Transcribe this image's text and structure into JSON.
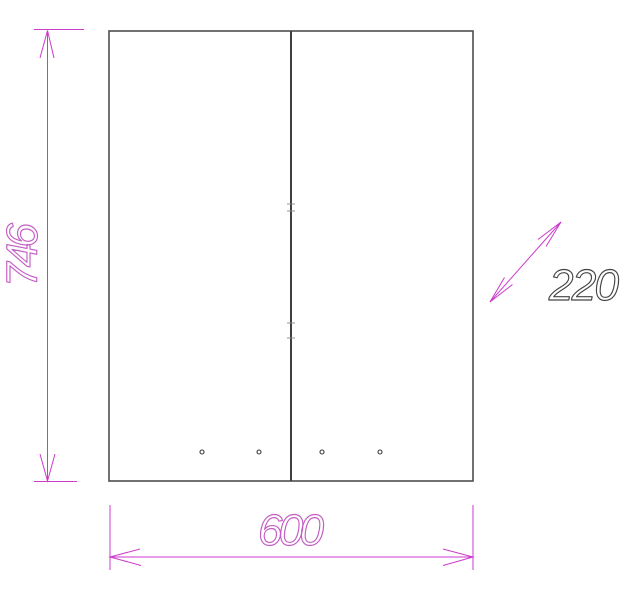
{
  "drawing": {
    "labels": {
      "height": "746",
      "width": "600",
      "depth": "220"
    },
    "colors": {
      "dimension": "#cc3acc",
      "dimension_text": "#c45ec4",
      "outline": "#4e4e4e",
      "divider": "#3f3f3f",
      "hinge_mark": "#8a8a8a",
      "hole": "#3a3a3a",
      "depth_text": "#454545",
      "background": "#ffffff"
    }
  }
}
